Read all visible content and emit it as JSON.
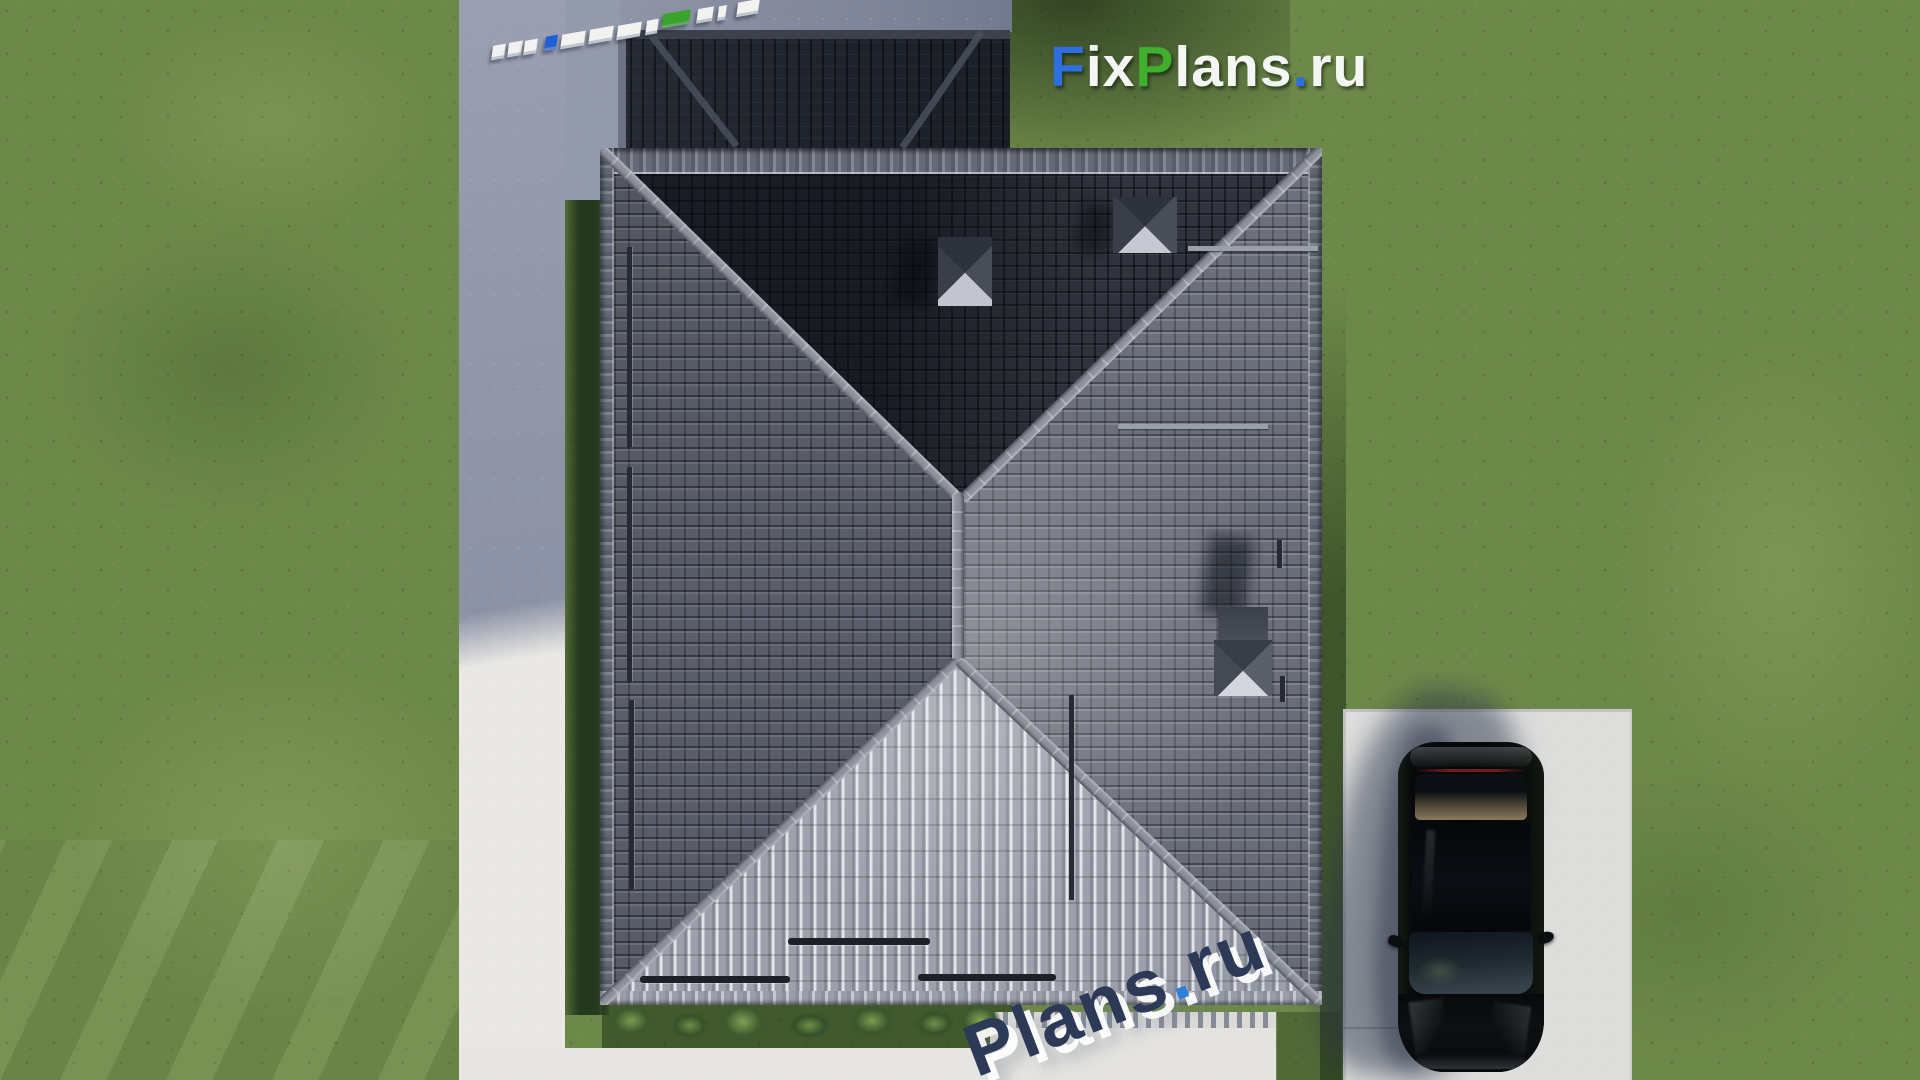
{
  "watermark_top": {
    "part_f": "F",
    "part_ix": "ix",
    "part_p": "P",
    "part_lans": "lans",
    "part_dot": ".",
    "part_ru": "ru"
  },
  "watermark_bottom": {
    "part_plans": "Plans",
    "part_dot": ".",
    "part_ru": "ru"
  },
  "colors": {
    "logo_blue": "#2e6fe0",
    "logo_green": "#3faf2d",
    "logo_white": "#f4f6f3",
    "watermark_navy": "#2c3a57",
    "watermark_dot_blue": "#2f7fd8",
    "grass": "#6d8949",
    "grass_shadow": "#24381e",
    "roof_north": "#2b2e38",
    "roof_west": "#5a5e6a",
    "roof_east": "#6d717d",
    "roof_south": "#a3a6b0",
    "roof_garage": "#20242c",
    "ridge_cap": "#8e929c",
    "driveway_shadow": "#9096a8",
    "pavement_white": "#e9e8e4",
    "car_black": "#0a0c0e"
  }
}
